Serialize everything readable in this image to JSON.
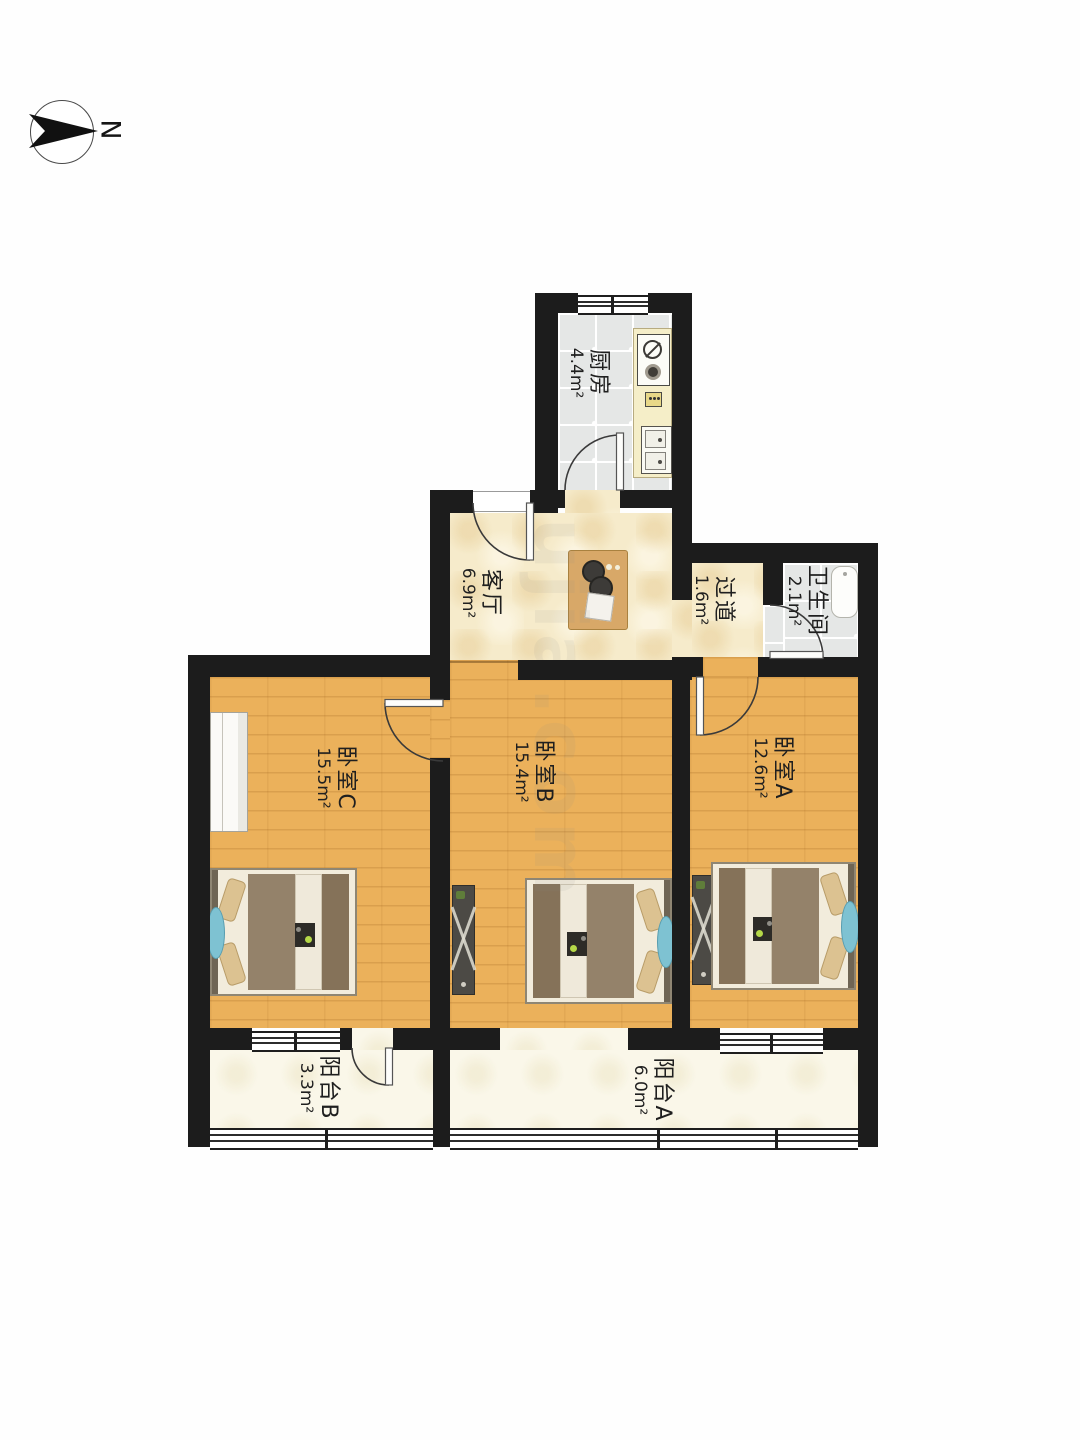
{
  "compass": {
    "label": "N"
  },
  "watermark": "ujia.com",
  "rooms": {
    "kitchen": {
      "name": "厨房",
      "area": "4.4m²"
    },
    "living": {
      "name": "客厅",
      "area": "6.9m²"
    },
    "hallway": {
      "name": "过道",
      "area": "1.6m²"
    },
    "bathroom": {
      "name": "卫生间",
      "area": "2.1m²"
    },
    "bedroomC": {
      "name": "卧室C",
      "area": "15.5m²"
    },
    "bedroomB": {
      "name": "卧室B",
      "area": "15.4m²"
    },
    "bedroomA": {
      "name": "卧室A",
      "area": "12.6m²"
    },
    "balconyB": {
      "name": "阳台B",
      "area": "3.3m²"
    },
    "balconyA": {
      "name": "阳台A",
      "area": "6.0m²"
    }
  },
  "colors": {
    "wall": "#1c1c1c",
    "wood_floor": "#ebb15b",
    "cream_floor": "#f6ebcb",
    "tile_floor": "#e5e7e6",
    "balcony_floor": "#faf7e9"
  }
}
